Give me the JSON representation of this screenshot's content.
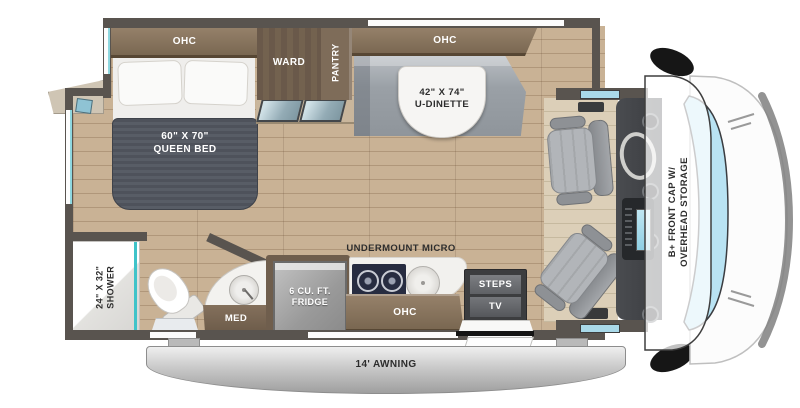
{
  "floorplan": {
    "areas": {
      "bedroom": {
        "ohc": "OHC",
        "bed_size": "60\" X 70\"",
        "bed_name": "QUEEN BED",
        "ward": "WARD",
        "pantry": "PANTRY"
      },
      "dinette": {
        "ohc": "OHC",
        "size": "42\" X 74\"",
        "name": "U-DINETTE"
      },
      "bathroom": {
        "shower_size": "24\" X 32\"",
        "shower_name": "SHOWER",
        "med": "MED"
      },
      "kitchen": {
        "fridge_line1": "6 CU. FT.",
        "fridge_line2": "FRIDGE",
        "micro": "UNDERMOUNT MICRO",
        "ohc": "OHC"
      },
      "entry": {
        "steps": "STEPS",
        "tv": "TV"
      },
      "cab": {
        "front_cap_line1": "B+ FRONT CAP W/",
        "front_cap_line2": "OVERHEAD STORAGE"
      },
      "exterior": {
        "awning": "14' AWNING"
      }
    },
    "colors": {
      "wall": "#59544f",
      "wood_floor": "#c9b295",
      "cabinet_brown": "#8d7963",
      "ward_brown": "#6a594a",
      "mattress_gray": "#4e525b",
      "bench_gray": "#9aa0a6",
      "cooktop_navy": "#272c40",
      "shower_glass_teal": "#3fc3c9",
      "windshield_blue": "#b9e3f3",
      "awning_gray": "#c9c9c9"
    }
  }
}
